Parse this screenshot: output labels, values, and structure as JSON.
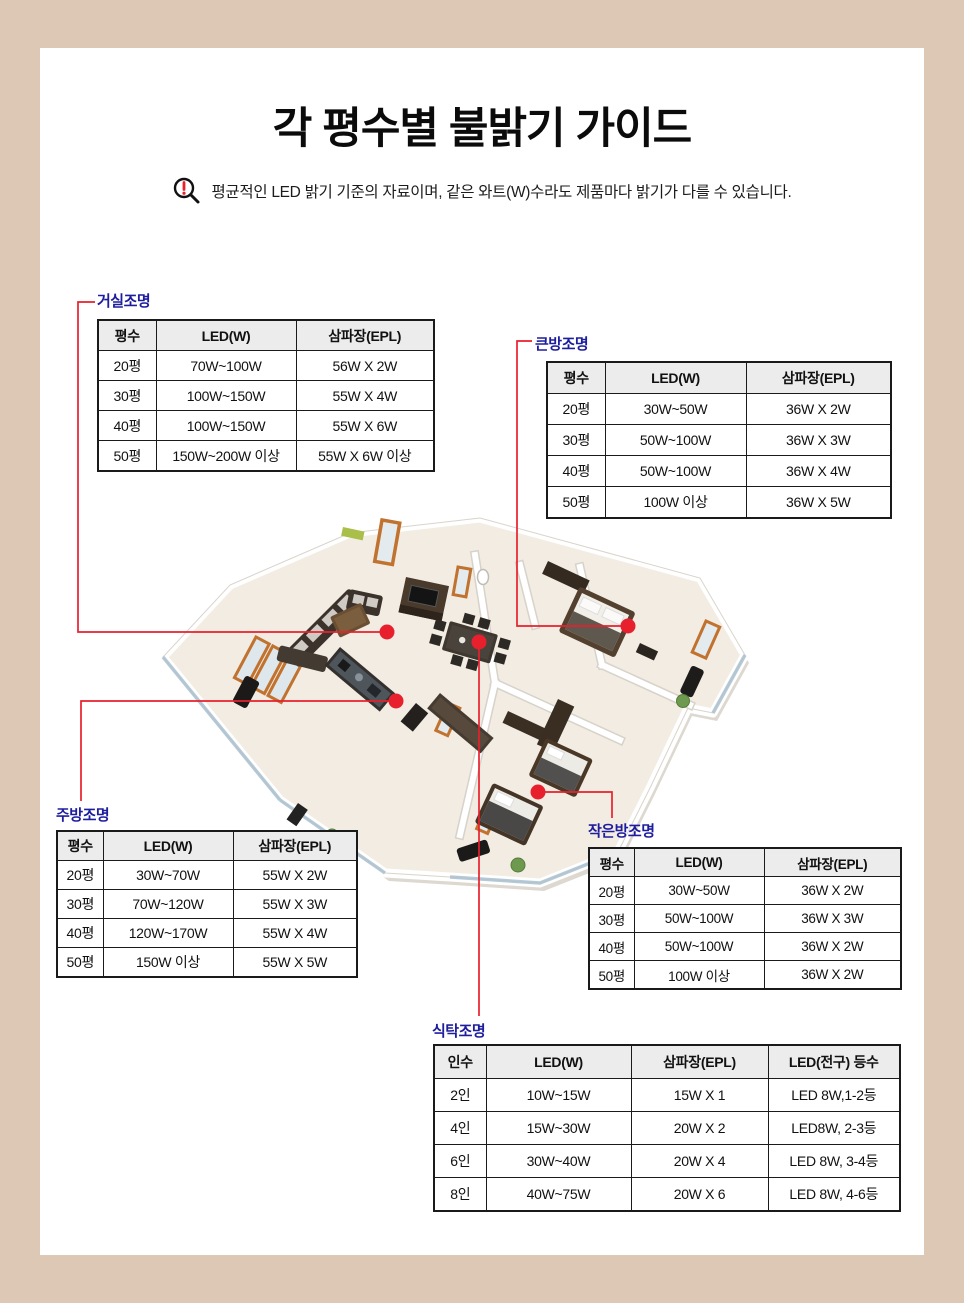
{
  "title": "각 평수별 불밝기 가이드",
  "notice": {
    "icon": "alert-magnifier-icon",
    "text": "평균적인 LED 밝기 기준의 자료이며, 같은 와트(W)수라도 제품마다 밝기가 다를 수 있습니다."
  },
  "colors": {
    "frame": "#dcc8b4",
    "accent_red": "#e8202d",
    "label_blue": "#1d1d9e",
    "table_header_bg": "#ececec",
    "table_border": "#1a1a1a"
  },
  "tables": [
    {
      "id": "living",
      "label": "거실조명",
      "headers": [
        "평수",
        "LED(W)",
        "삼파장(EPL)"
      ],
      "rows": [
        [
          "20평",
          "70W~100W",
          "56W X 2W"
        ],
        [
          "30평",
          "100W~150W",
          "55W X 4W"
        ],
        [
          "40평",
          "100W~150W",
          "55W X 6W"
        ],
        [
          "50평",
          "150W~200W 이상",
          "55W X 6W 이상"
        ]
      ]
    },
    {
      "id": "bigroom",
      "label": "큰방조명",
      "headers": [
        "평수",
        "LED(W)",
        "삼파장(EPL)"
      ],
      "rows": [
        [
          "20평",
          "30W~50W",
          "36W X 2W"
        ],
        [
          "30평",
          "50W~100W",
          "36W X 3W"
        ],
        [
          "40평",
          "50W~100W",
          "36W X 4W"
        ],
        [
          "50평",
          "100W 이상",
          "36W X 5W"
        ]
      ]
    },
    {
      "id": "kitchen",
      "label": "주방조명",
      "headers": [
        "평수",
        "LED(W)",
        "삼파장(EPL)"
      ],
      "rows": [
        [
          "20평",
          "30W~70W",
          "55W X 2W"
        ],
        [
          "30평",
          "70W~120W",
          "55W X 3W"
        ],
        [
          "40평",
          "120W~170W",
          "55W X 4W"
        ],
        [
          "50평",
          "150W 이상",
          "55W X 5W"
        ]
      ]
    },
    {
      "id": "smallroom",
      "label": "작은방조명",
      "headers": [
        "평수",
        "LED(W)",
        "삼파장(EPL)"
      ],
      "rows": [
        [
          "20평",
          "30W~50W",
          "36W X 2W"
        ],
        [
          "30평",
          "50W~100W",
          "36W X 3W"
        ],
        [
          "40평",
          "50W~100W",
          "36W X 2W"
        ],
        [
          "50평",
          "100W 이상",
          "36W X 2W"
        ]
      ]
    },
    {
      "id": "dining",
      "label": "식탁조명",
      "headers": [
        "인수",
        "LED(W)",
        "삼파장(EPL)",
        "LED(전구) 등수"
      ],
      "rows": [
        [
          "2인",
          "10W~15W",
          "15W X 1",
          "LED 8W,1-2등"
        ],
        [
          "4인",
          "15W~30W",
          "20W X 2",
          "LED8W, 2-3등"
        ],
        [
          "6인",
          "30W~40W",
          "20W X 4",
          "LED 8W, 3-4등"
        ],
        [
          "8인",
          "40W~75W",
          "20W X 6",
          "LED 8W, 4-6등"
        ]
      ]
    }
  ],
  "floorplan": {
    "markers": [
      "living-room",
      "dining-table",
      "kitchen",
      "big-room",
      "small-room"
    ]
  }
}
